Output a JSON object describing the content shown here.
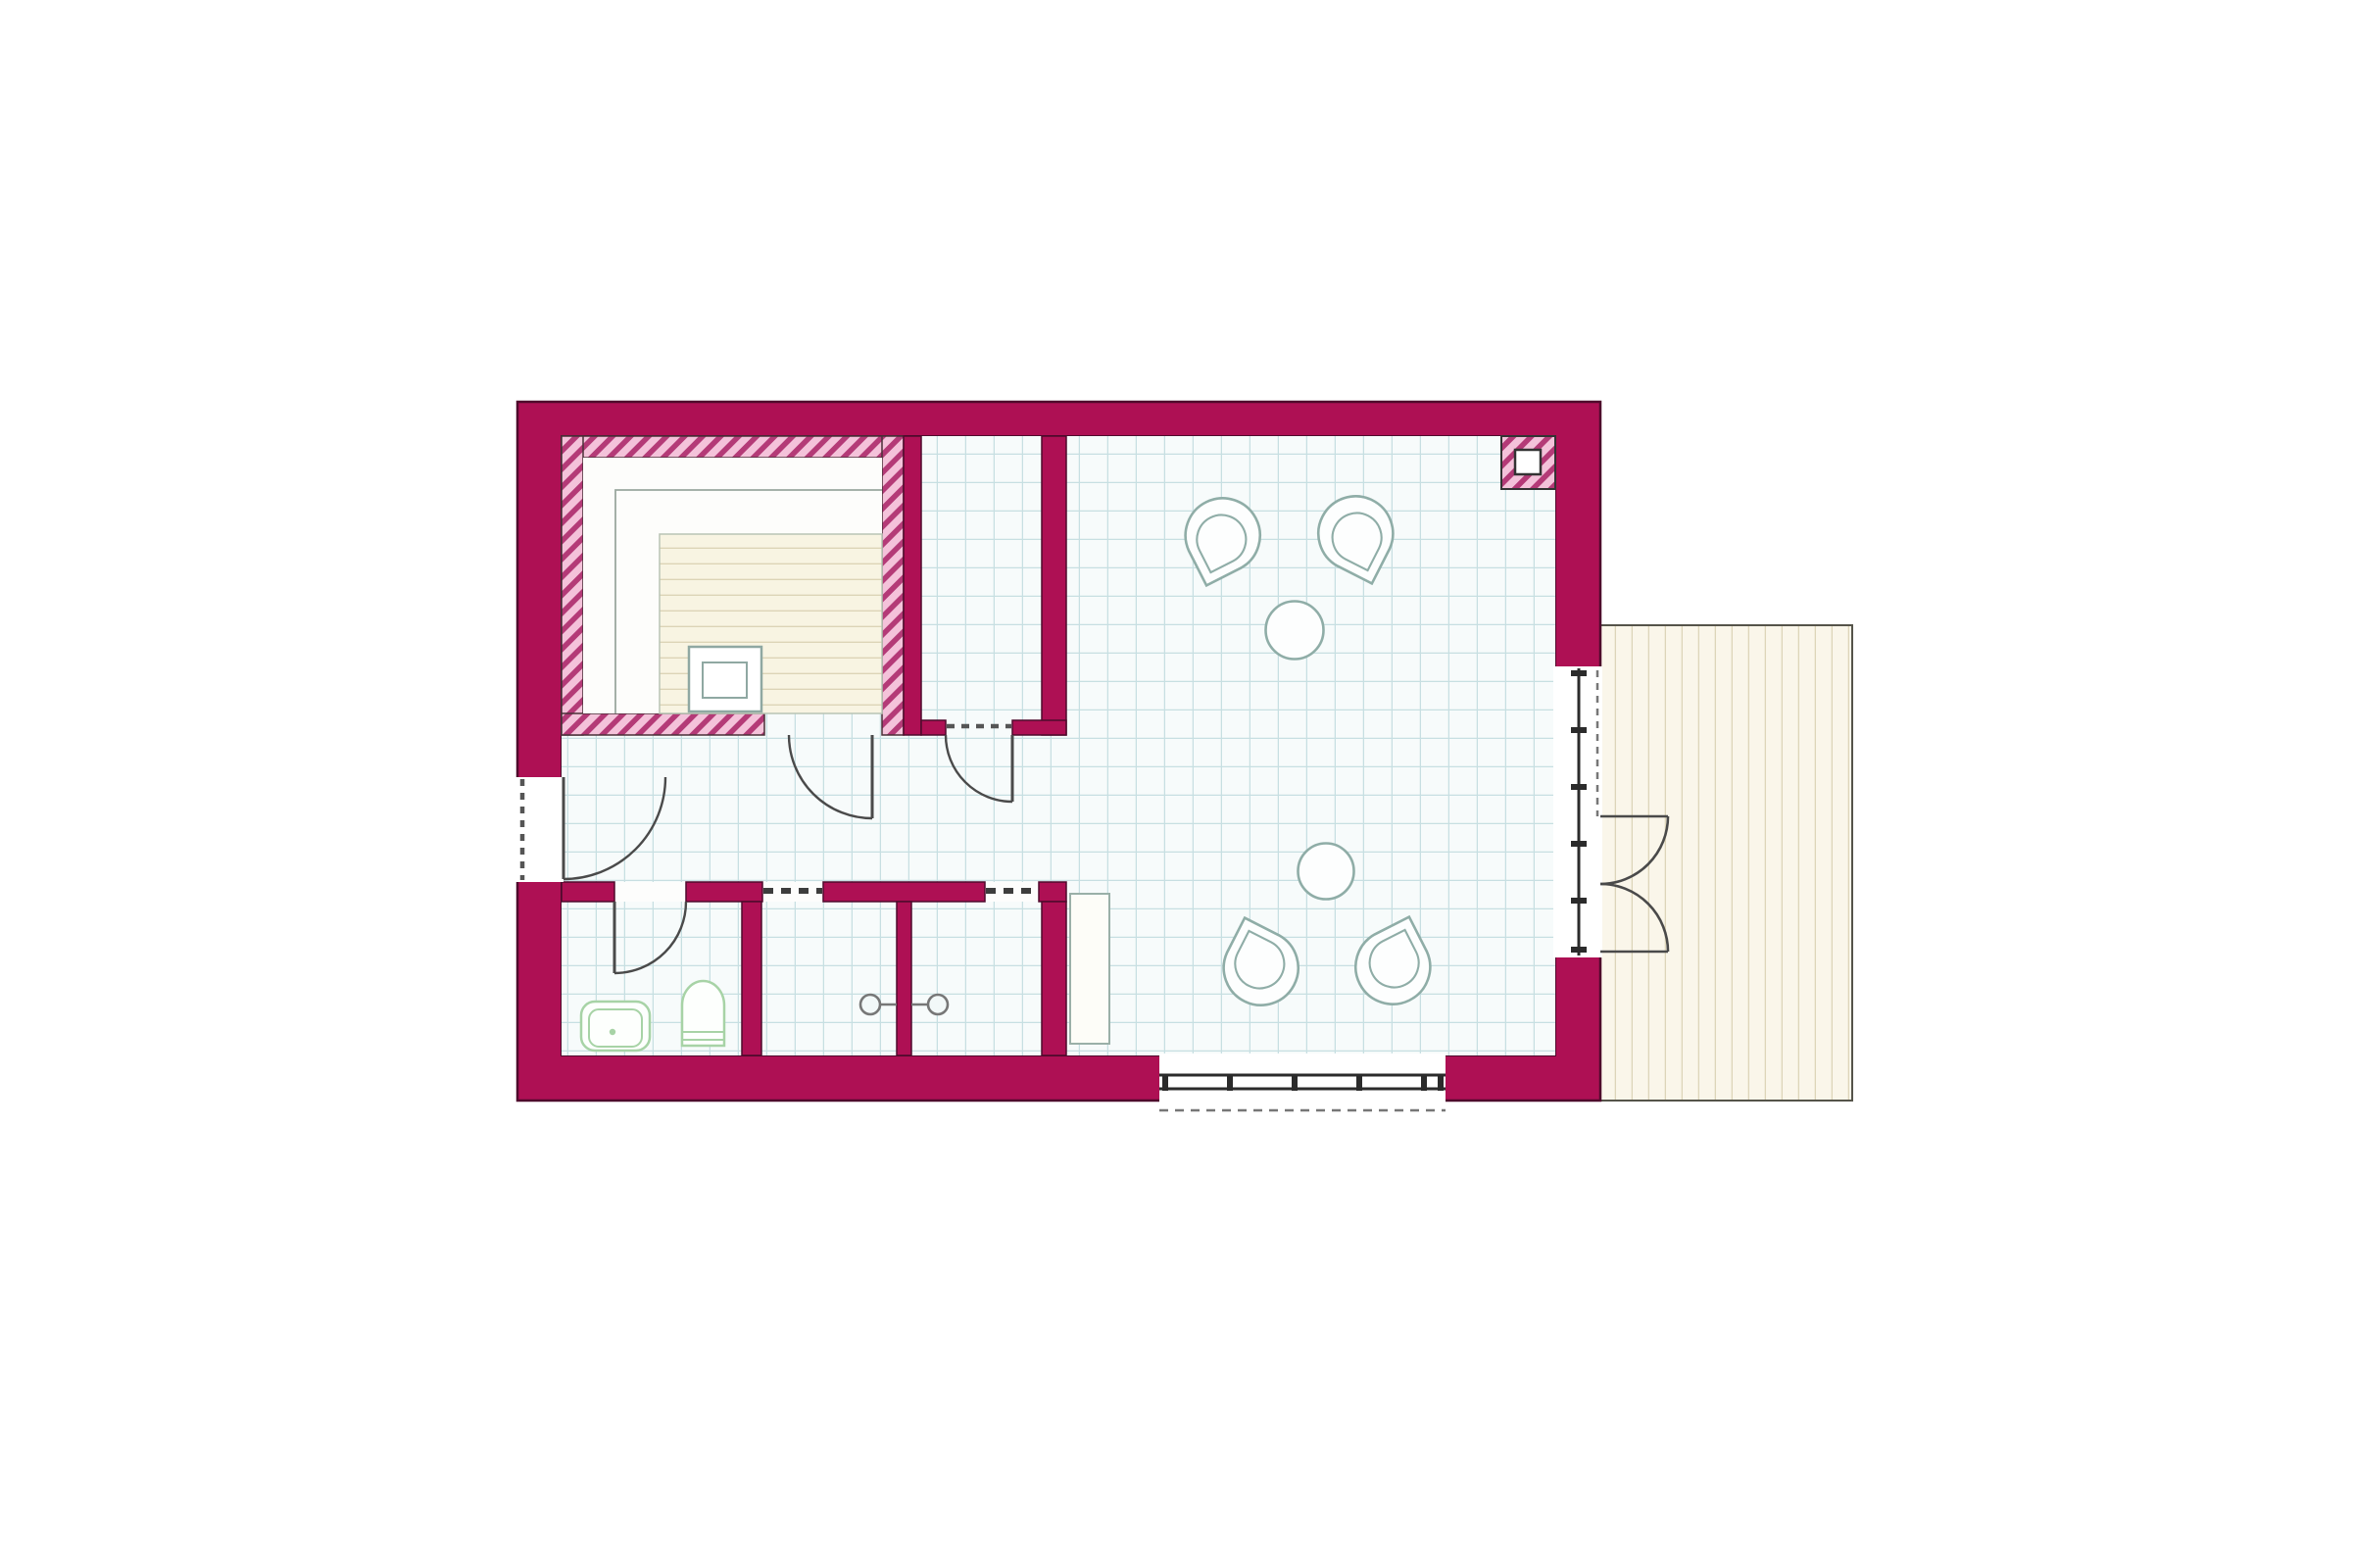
{
  "page": {
    "background": "#ffffff",
    "content": "architectural floor plan drawing, no text labels"
  },
  "palette": {
    "wall_fill": "#ae1054",
    "wall_outline": "#4f0a2c",
    "hatch_background": "#f4c2da",
    "hatch_stripe": "#b43a77",
    "tile_background": "#f7fbfb",
    "tile_line": "#c7dfe2",
    "deck_fill": "#faf6ea",
    "deck_plank_line": "#ddd5b9",
    "deck_outline": "#55544a",
    "bench_wood_fill": "#f8f4e2",
    "bench_wood_line": "#dcd4b6",
    "furniture_line": "#8fada7",
    "fixture_line": "#a7d3a6",
    "door_line": "#4a4a4a",
    "window_line": "#2b2b2b",
    "dash_line": "#555555"
  },
  "plan": {
    "rooms": [
      {
        "id": "sauna",
        "floor": "plain",
        "features": [
          "tiered-bench",
          "heater"
        ]
      },
      {
        "id": "shower-room",
        "floor": "tiles"
      },
      {
        "id": "hallway",
        "floor": "tiles"
      },
      {
        "id": "bathroom",
        "floor": "tiles",
        "fixtures": [
          "sink",
          "toilet"
        ]
      },
      {
        "id": "shower-stall-left",
        "floor": "tiles",
        "fixtures": [
          "shower-head"
        ]
      },
      {
        "id": "shower-stall-right",
        "floor": "tiles",
        "fixtures": [
          "shower-head"
        ]
      },
      {
        "id": "main-room",
        "floor": "tiles",
        "features": [
          "corner-column",
          "wall-bench"
        ]
      },
      {
        "id": "terrace-deck",
        "floor": "planks"
      }
    ],
    "seating_groups": [
      {
        "chairs": 2,
        "round_tables": 1,
        "position": "upper"
      },
      {
        "chairs": 2,
        "round_tables": 1,
        "position": "lower"
      }
    ],
    "doors": {
      "entrance_left_wall": 1,
      "interior_swing_doors": 3,
      "french_door_pair_to_deck": 1
    },
    "windows": {
      "right_wall_glazing": 1,
      "bottom_wall_glazing": 1
    },
    "curtain_openings_dashed": 3
  }
}
